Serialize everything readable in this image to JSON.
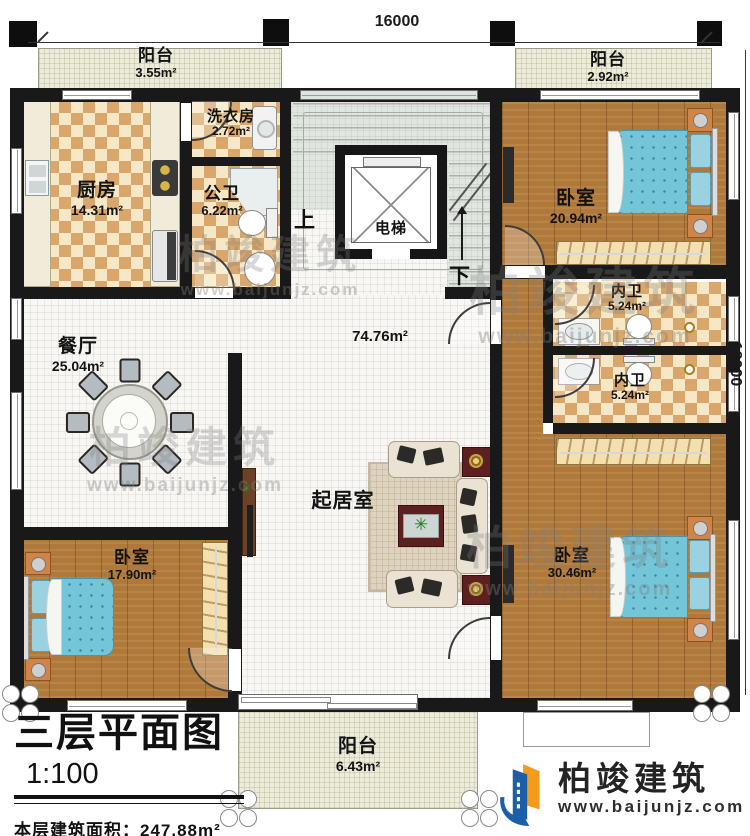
{
  "dimensions": {
    "top": "16000",
    "right": "18000"
  },
  "rooms": {
    "balcony_top_left": {
      "name": "阳台",
      "area": "3.55m²"
    },
    "balcony_top_right": {
      "name": "阳台",
      "area": "2.92m²"
    },
    "balcony_bottom": {
      "name": "阳台",
      "area": "6.43m²"
    },
    "kitchen": {
      "name": "厨房",
      "area": "14.31m²"
    },
    "laundry": {
      "name": "洗衣房",
      "area": "2.72m²"
    },
    "public_bath": {
      "name": "公卫",
      "area": "6.22m²"
    },
    "elevator": {
      "name": "电梯"
    },
    "stairs": {
      "up": "上",
      "down": "下"
    },
    "bedroom_top_right": {
      "name": "卧室",
      "area": "20.94m²"
    },
    "ensuite_bath_1": {
      "name": "内卫",
      "area": "5.24m²"
    },
    "ensuite_bath_2": {
      "name": "内卫",
      "area": "5.24m²"
    },
    "dining": {
      "name": "餐厅",
      "area": "25.04m²"
    },
    "living": {
      "name": "起居室",
      "area": "74.76m²"
    },
    "bedroom_bottom_left": {
      "name": "卧室",
      "area": "17.90m²"
    },
    "bedroom_bottom_right": {
      "name": "卧室",
      "area": "30.46m²"
    }
  },
  "title_block": {
    "title": "三层平面图",
    "scale": "1:100",
    "area_label": "本层建筑面积：",
    "area_value": "247.88m²",
    "floor_height_label": "层高：",
    "floor_height_value": "3.2m"
  },
  "brand": {
    "name": "柏竣建筑",
    "website": "www.baijunjz.com"
  },
  "watermark": {
    "name": "柏竣建筑",
    "website": "www.baijunjz.com"
  },
  "colors": {
    "wall": "#191919",
    "wood": "#b0793c",
    "checker_light": "#f6e8c6",
    "checker_dark": "#d9a76c",
    "tile": "#f8f7f4",
    "balcony_floor": "#edecdb",
    "stair_floor": "#e1e6e0",
    "bed_blue": "#74c5d8",
    "nightstand_orange": "#d08448",
    "cabinet_maroon": "#5d1f1f",
    "logo_blue": "#1c5fa8",
    "logo_orange": "#f29b1d"
  }
}
